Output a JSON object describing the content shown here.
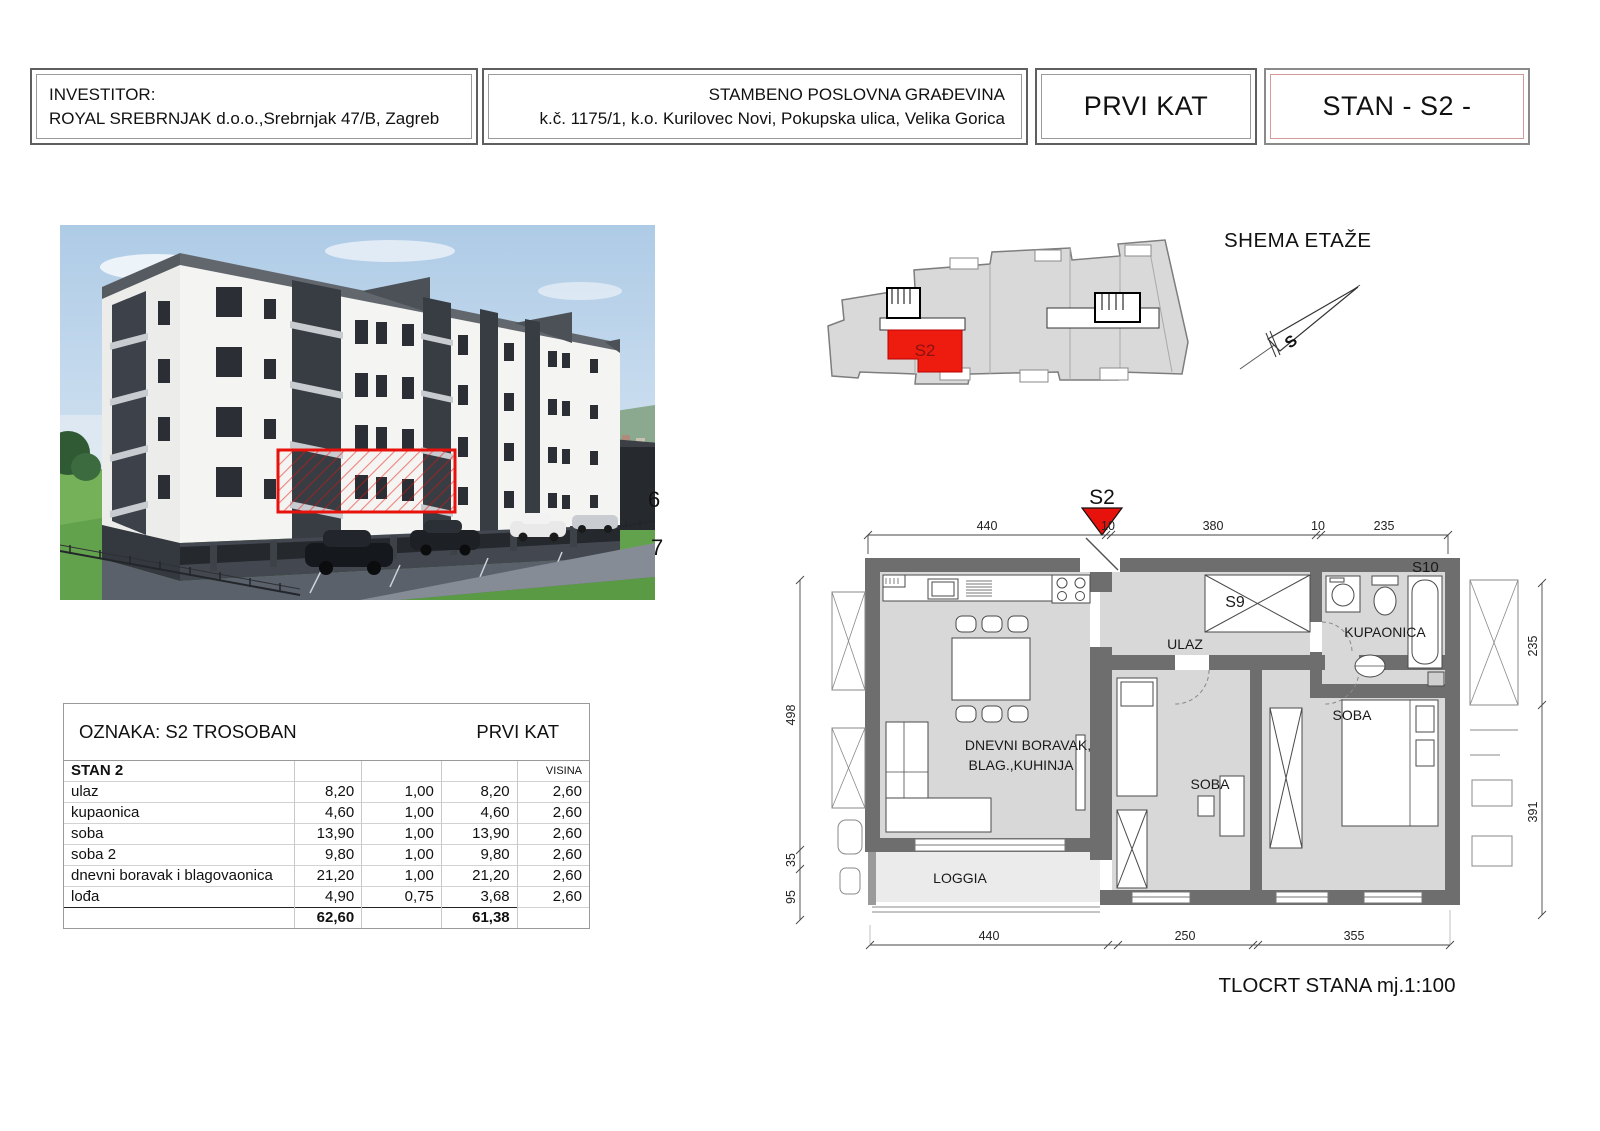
{
  "header": {
    "investor_label": "INVESTITOR:",
    "investor_name": "ROYAL SREBRNJAK d.o.o.,Srebrnjak 47/B, Zagreb",
    "building_title": "STAMBENO POSLOVNA GRAĐEVINA",
    "building_address": "k.č. 1175/1, k.o. Kurilovec Novi, Pokupska ulica, Velika Gorica",
    "floor_label": "PRVI KAT",
    "unit_label": "STAN - S2 -"
  },
  "render": {
    "fragment_6": "6",
    "fragment_7": "7"
  },
  "schema": {
    "title": "SHEMA ETAŽE",
    "unit_label": "S2",
    "north_label": "S"
  },
  "area_table": {
    "title_left": "OZNAKA: S2  TROSOBAN",
    "title_right": "PRVI KAT",
    "header_name": "STAN 2",
    "header_visina": "VISINA",
    "rows": [
      {
        "name": "ulaz",
        "area": "8,20",
        "coef": "1,00",
        "net": "8,20",
        "height": "2,60"
      },
      {
        "name": "kupaonica",
        "area": "4,60",
        "coef": "1,00",
        "net": "4,60",
        "height": "2,60"
      },
      {
        "name": "soba",
        "area": "13,90",
        "coef": "1,00",
        "net": "13,90",
        "height": "2,60"
      },
      {
        "name": "soba  2",
        "area": "9,80",
        "coef": "1,00",
        "net": "9,80",
        "height": "2,60"
      },
      {
        "name": "dnevni boravak i blagovaonica",
        "area": "21,20",
        "coef": "1,00",
        "net": "21,20",
        "height": "2,60"
      },
      {
        "name": "lođa",
        "area": "4,90",
        "coef": "0,75",
        "net": "3,68",
        "height": "2,60"
      }
    ],
    "total_area": "62,60",
    "total_net": "61,38"
  },
  "floor_plan": {
    "marker": "S2",
    "caption": "TLOCRT STANA mj.1:100",
    "rooms": {
      "ulaz": "ULAZ",
      "kupaonica": "KUPAONICA",
      "soba_1": "SOBA",
      "soba_2": "SOBA",
      "living_line1": "DNEVNI BORAVAK,",
      "living_line2": "BLAG.,KUHINJA",
      "loggia": "LOGGIA",
      "closet": "S9",
      "neighbor": "S10"
    },
    "dims_top": [
      "440",
      "10",
      "380",
      "10",
      "235"
    ],
    "dims_bottom": [
      "440",
      "250",
      "355"
    ],
    "dims_left": [
      "498",
      "35",
      "95"
    ],
    "dims_right": [
      "235",
      "391"
    ]
  },
  "colors": {
    "accent_red": "#e8120c",
    "wall": "#6e6e6e",
    "room_fill": "#d8d8d8"
  }
}
